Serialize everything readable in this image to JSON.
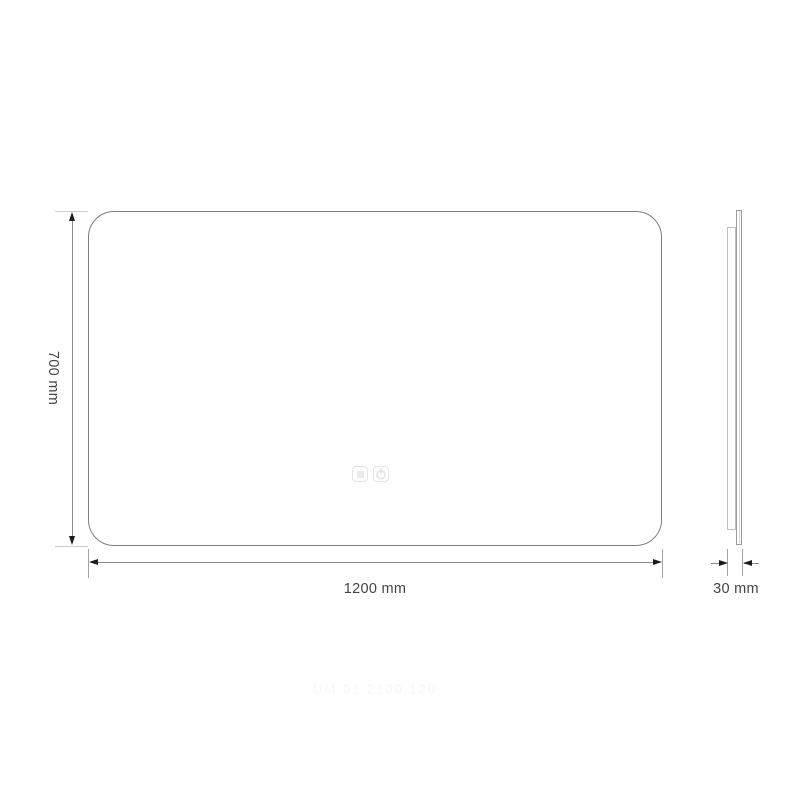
{
  "page": {
    "background": "#ffffff",
    "description": "Technical dimension drawing of a rectangular LED mirror with touch controls, front and side views"
  },
  "dimensions": {
    "height": {
      "label": "700 mm",
      "value": 700,
      "unit": "mm"
    },
    "width": {
      "label": "1200 mm",
      "value": 1200,
      "unit": "mm"
    },
    "depth": {
      "label": "30 mm",
      "value": 30,
      "unit": "mm"
    }
  },
  "views": {
    "front": {
      "shape": "rounded-rectangle",
      "touch_icons": [
        {
          "name": "light-touch-sensor",
          "glyph": "filled-square"
        },
        {
          "name": "power-touch-sensor",
          "glyph": "power-symbol"
        }
      ]
    },
    "side": {
      "parts": [
        "glass-pane",
        "back-panel"
      ]
    }
  },
  "watermark": {
    "text": "UM 01 2100 120"
  },
  "colors": {
    "outline": "#7e7e7e",
    "dimension_line": "#8a8a8a",
    "extension_line": "#cccccc",
    "arrow": "#1c1c1c",
    "label_text": "#474243",
    "touch_icon": "#e3e3e3",
    "watermark": "#f7f7f7"
  }
}
